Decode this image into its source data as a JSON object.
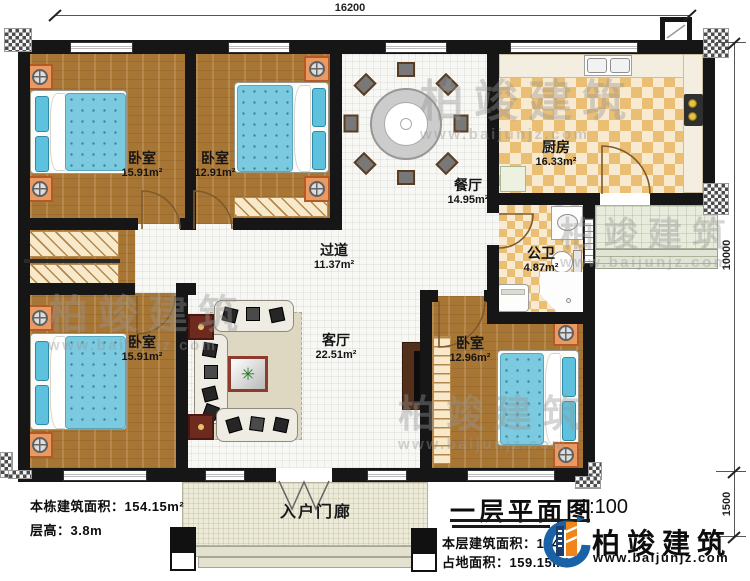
{
  "title_block": {
    "title": "一层平面图",
    "scale": "1:100",
    "floor_area": "本层建筑面积：154",
    "land_area": "占地面积：159.15m²"
  },
  "info_block": {
    "building_area": "本栋建筑面积：154.15m²",
    "floor_height": "层高：3.8m"
  },
  "brand": {
    "name": "柏竣建筑",
    "website": "www.baijunjz.com"
  },
  "watermark": {
    "name": "柏竣建筑",
    "website": "www.baijunjz.com"
  },
  "dimensions": {
    "top": "16200",
    "right_upper": "10000",
    "right_lower": "1500"
  },
  "rooms": {
    "bedroom_tl": {
      "name": "卧室",
      "area": "15.91m²"
    },
    "bedroom_tm": {
      "name": "卧室",
      "area": "12.91m²"
    },
    "dining": {
      "name": "餐厅",
      "area": "14.95m²"
    },
    "kitchen": {
      "name": "厨房",
      "area": "16.33m²"
    },
    "hallway": {
      "name": "过道",
      "area": "11.37m²"
    },
    "bathroom": {
      "name": "公卫",
      "area": "4.87m²"
    },
    "living": {
      "name": "客厅",
      "area": "22.51m²"
    },
    "bedroom_bl": {
      "name": "卧室",
      "area": "15.91m²"
    },
    "bedroom_br": {
      "name": "卧室",
      "area": "12.96m²"
    },
    "entry_porch": {
      "name": "入户门廊"
    }
  },
  "colors": {
    "wall": "#161616",
    "wood_floor": "#a87634",
    "tile": "#eabf74",
    "bed_blue": "#7ccadf",
    "brand_blue": "#1a62a7",
    "brand_orange": "#f08519"
  }
}
